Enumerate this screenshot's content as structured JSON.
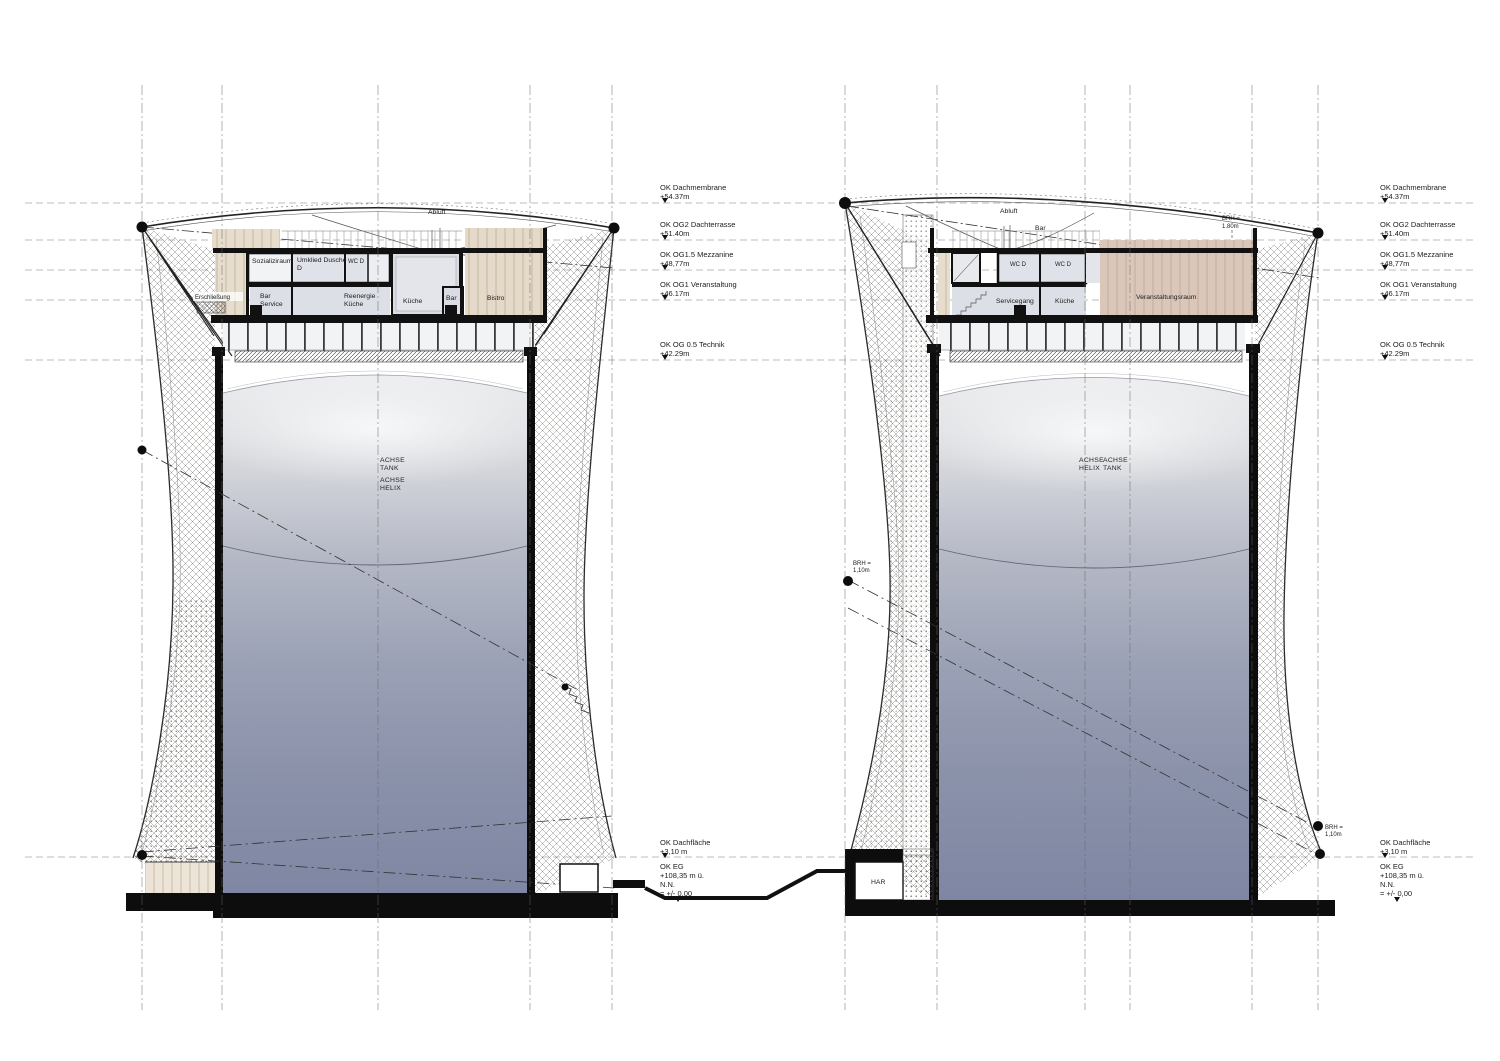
{
  "levels": [
    {
      "label": "OK Dachmembrane",
      "value": "+54.37m"
    },
    {
      "label": "OK OG2 Dachterrasse",
      "value": "+51.40m"
    },
    {
      "label": "OK OG1.5 Mezzanine",
      "value": "+48,77m"
    },
    {
      "label": "OK OG1 Veranstaltung",
      "value": "+46.17m"
    },
    {
      "label": "OK OG 0.5 Technik",
      "value": "+42.29m"
    },
    {
      "label": "OK Dachfläche",
      "value": "+3,10 m"
    },
    {
      "label": "OK EG",
      "value": "+108,35 m ü.",
      "value2": "N.N.",
      "value3": "= +/- 0,00"
    }
  ],
  "left_tower": {
    "abluft": "Abluft",
    "room_sozialraum": "Sozializiraum",
    "room_umkleid_line1": "Umklied Dusche",
    "room_umkleid_line2": "D",
    "room_wc": "WC D",
    "erschliessung": "Erschließung",
    "room_bar_service_line1": "Bar",
    "room_bar_service_line2": "Service",
    "room_reenergie_line1": "Reenergie",
    "room_reenergie_line2": "Küche",
    "room_kueche": "Küche",
    "room_bar": "Bar",
    "room_bistro": "Bistro",
    "axis_tank_line1": "ACHSE",
    "axis_tank_line2": "TANK",
    "axis_helix_line1": "ACHSE",
    "axis_helix_line2": "HELIX"
  },
  "right_tower": {
    "abluft": "Abluft",
    "roof_bar": "Bar",
    "brh_terrace_line1": "BRH =",
    "brh_terrace_line2": "1.80m",
    "room_wc_left": "WC D",
    "room_wc_right": "WC D",
    "room_servicegang": "Servicegang",
    "room_kueche": "Küche",
    "room_veranstaltungsraum": "Veranstaltungsraum",
    "axis_helix_line1": "ACHSE",
    "axis_helix_line2": "HELIX",
    "axis_tank_line1": "ACHSE",
    "axis_tank_line2": "TANK",
    "brh_waist_line1": "BRH =",
    "brh_waist_line2": "1,10m",
    "brh_base_line1": "BRH =",
    "brh_base_line2": "1,10m",
    "har": "HAR"
  }
}
